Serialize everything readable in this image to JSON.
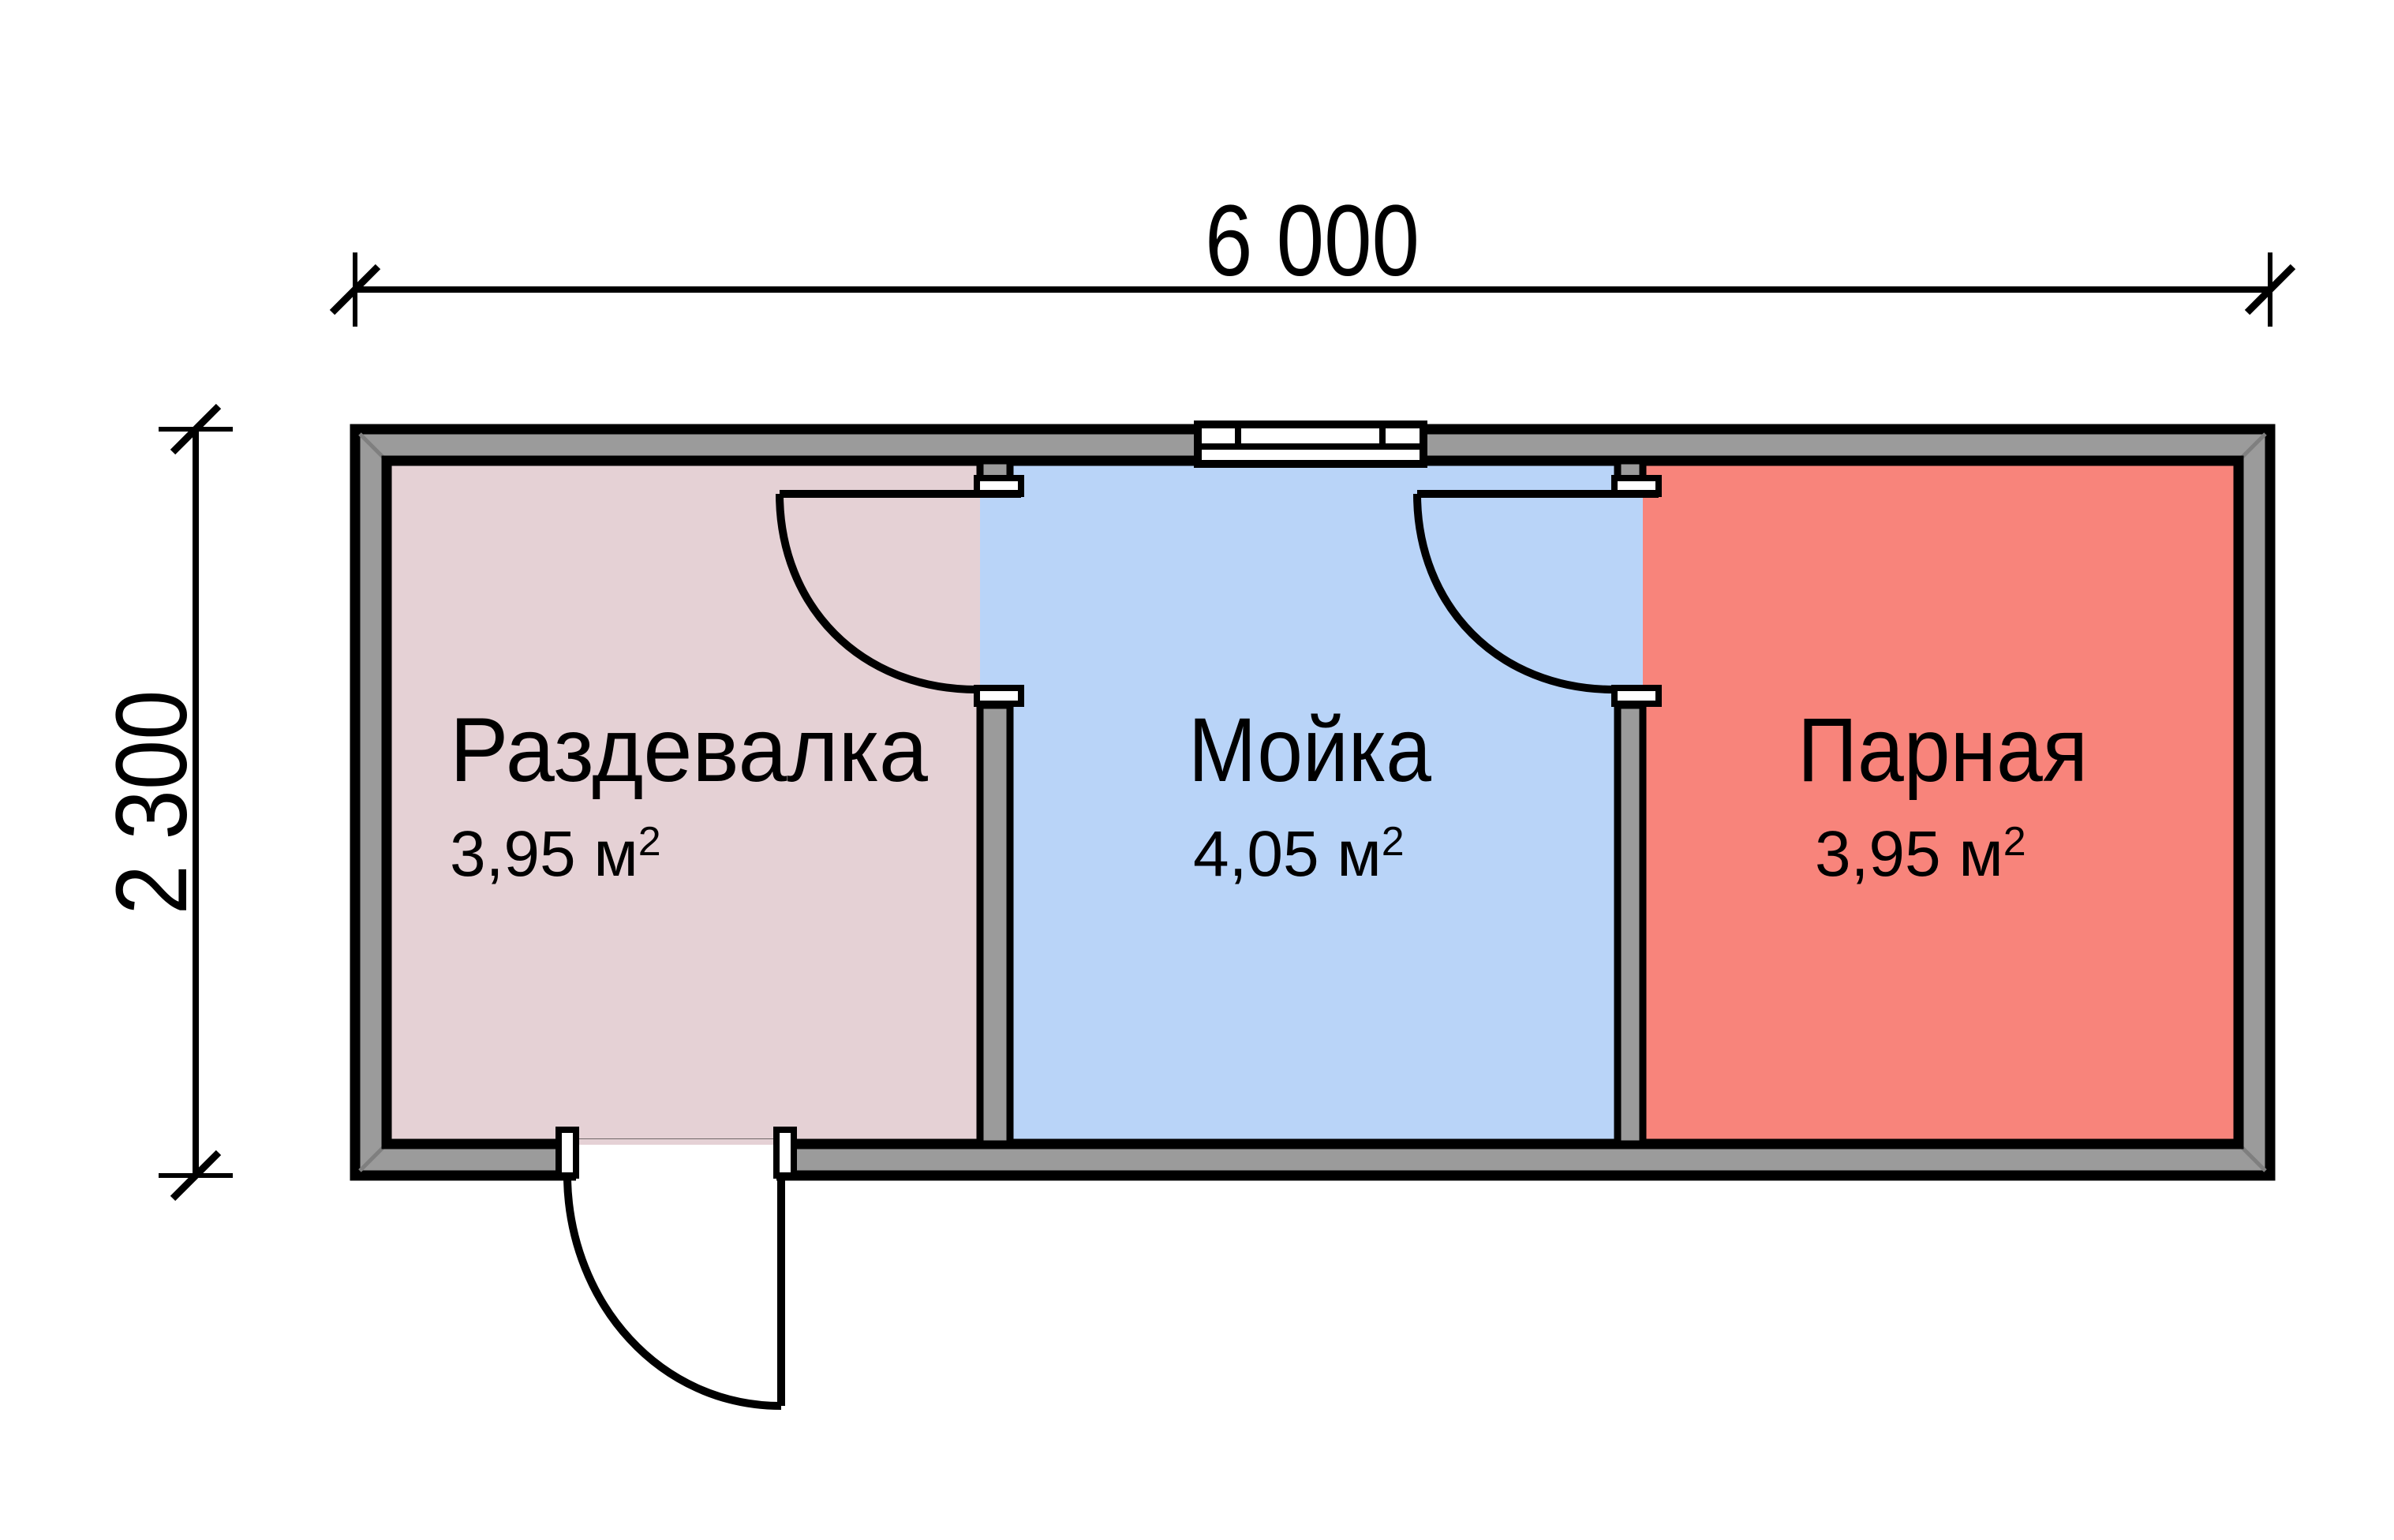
{
  "plan": {
    "dimensions": {
      "width": "6 000",
      "height": "2 300"
    },
    "wall_color": "#9b9b9b",
    "outline_color": "#000000",
    "rooms": [
      {
        "name": "Раздевалка",
        "area": "3,95 м",
        "area_sup": "2",
        "color": "#e5d1d5"
      },
      {
        "name": "Мойка",
        "area": "4,05 м",
        "area_sup": "2",
        "color": "#b9d4f8"
      },
      {
        "name": "Парная",
        "area": "3,95 м",
        "area_sup": "2",
        "color": "#f8847b"
      }
    ]
  }
}
